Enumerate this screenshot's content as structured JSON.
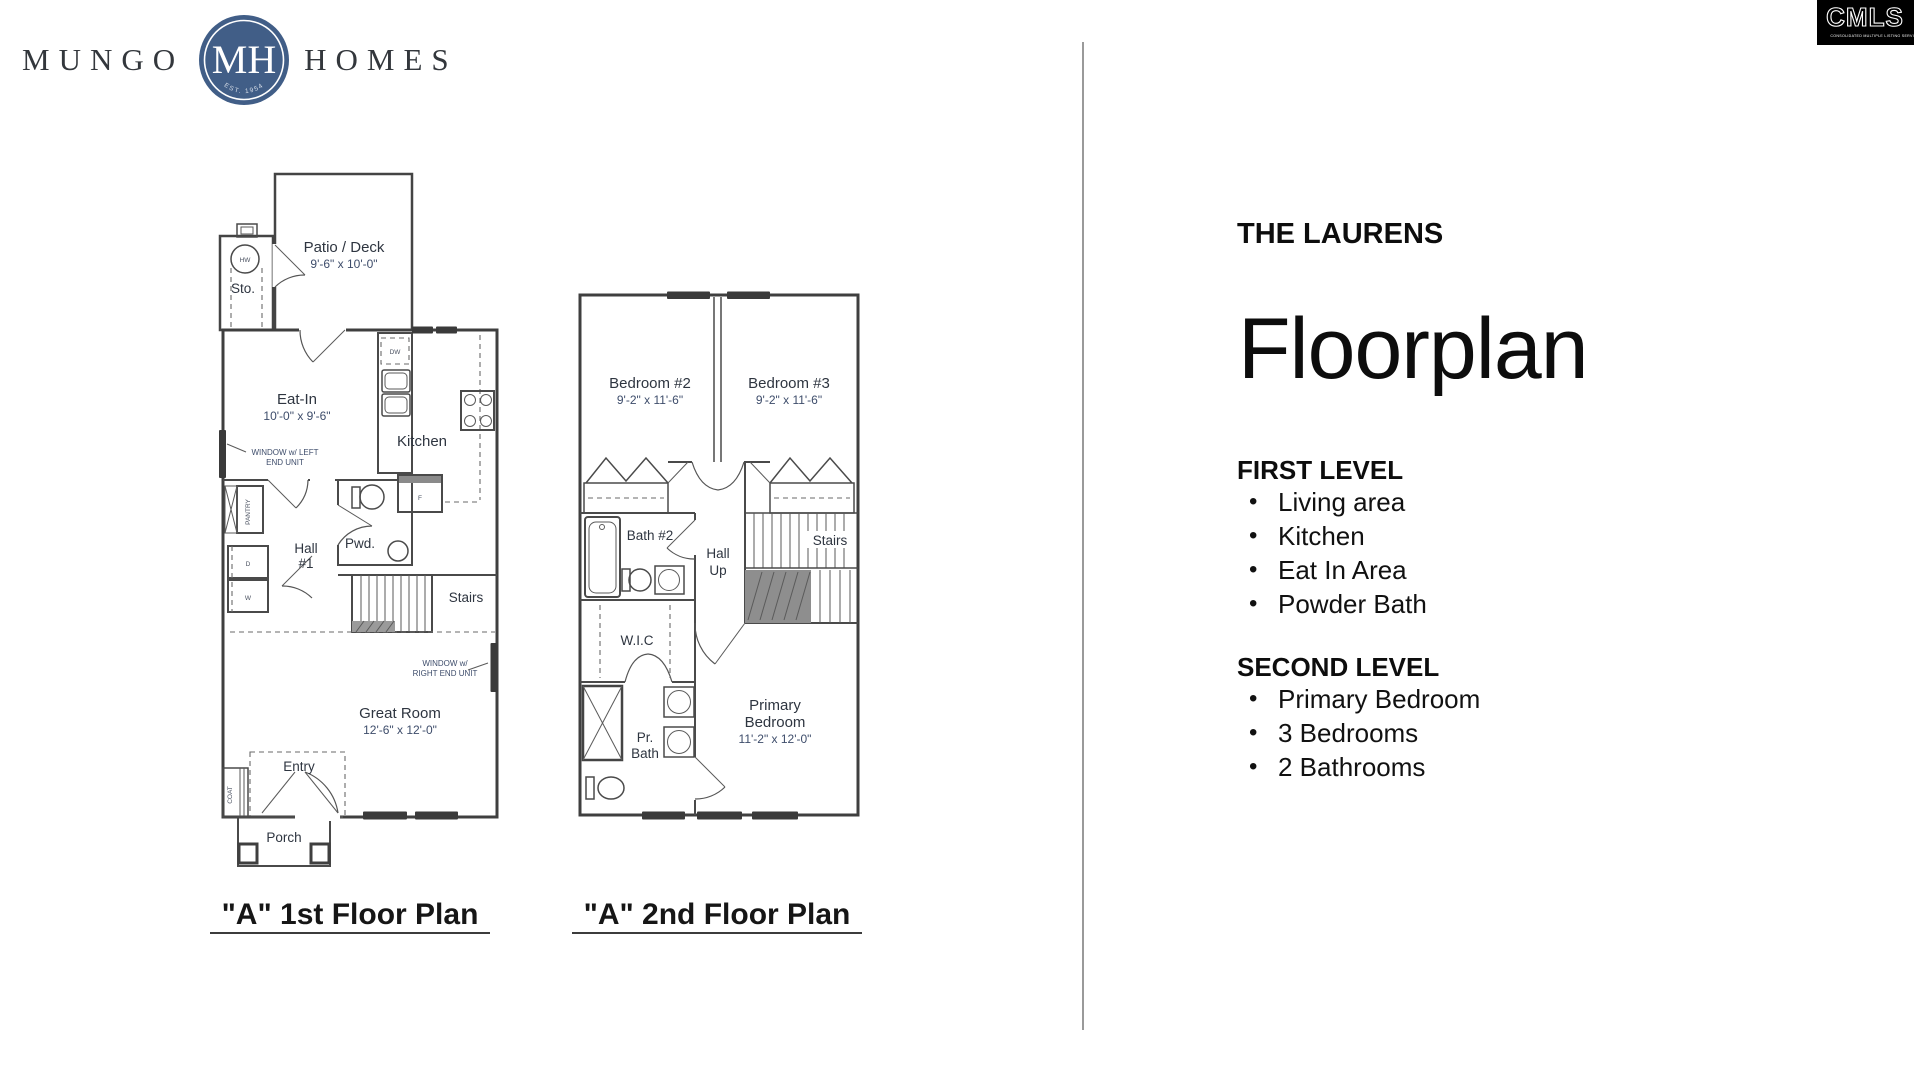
{
  "brand": {
    "word_left": "MUNGO",
    "word_right": "HOMES",
    "monogram": "MH",
    "established": "EST. 1954"
  },
  "cmls_badge": {
    "acronym": "CMLS",
    "subtitle": "CONSOLIDATED MULTIPLE LISTING SERVICE"
  },
  "colors": {
    "brand_circle": "#415e87",
    "divider": "#9a9a9a"
  },
  "details_panel": {
    "plan_name": "THE LAURENS",
    "title": "Floorplan",
    "bullet": "•",
    "sections": [
      {
        "heading": "FIRST LEVEL",
        "items": [
          "Living area",
          "Kitchen",
          "Eat In Area",
          "Powder Bath"
        ]
      },
      {
        "heading": "SECOND LEVEL",
        "items": [
          "Primary Bedroom",
          "3 Bedrooms",
          "2 Bathrooms"
        ]
      }
    ]
  },
  "floor_plan_1": {
    "caption": "\"A\" 1st Floor Plan",
    "labels": {
      "patio_name": "Patio / Deck",
      "patio_dims": "9'-6\" x 10'-0\"",
      "storage": "Sto.",
      "water_heater": "HW",
      "eat_in_name": "Eat-In",
      "eat_in_dims": "10'-0\" x 9'-6\"",
      "window_left_1": "WINDOW w/ LEFT",
      "window_left_2": "END UNIT",
      "kitchen": "Kitchen",
      "dishwasher": "DW",
      "fridge": "F",
      "pantry": "PANTRY",
      "hall_1": "Hall",
      "hall_2": "#1",
      "powder": "Pwd.",
      "dryer": "D",
      "washer": "W",
      "stairs": "Stairs",
      "window_right_1": "WINDOW w/",
      "window_right_2": "RIGHT END UNIT",
      "great_room_name": "Great Room",
      "great_room_dims": "12'-6\" x 12'-0\"",
      "entry": "Entry",
      "coat": "COAT",
      "porch": "Porch"
    }
  },
  "floor_plan_2": {
    "caption": "\"A\" 2nd Floor Plan",
    "labels": {
      "bedroom2_name": "Bedroom #2",
      "bedroom2_dims": "9'-2\" x 11'-6\"",
      "bedroom3_name": "Bedroom #3",
      "bedroom3_dims": "9'-2\" x 11'-6\"",
      "bath2": "Bath #2",
      "hall_1": "Hall",
      "hall_2": "Up",
      "stairs": "Stairs",
      "wic": "W.I.C",
      "pr_bath_1": "Pr.",
      "pr_bath_2": "Bath",
      "primary_1": "Primary",
      "primary_2": "Bedroom",
      "primary_dims": "11'-2\" x 12'-0\""
    }
  }
}
